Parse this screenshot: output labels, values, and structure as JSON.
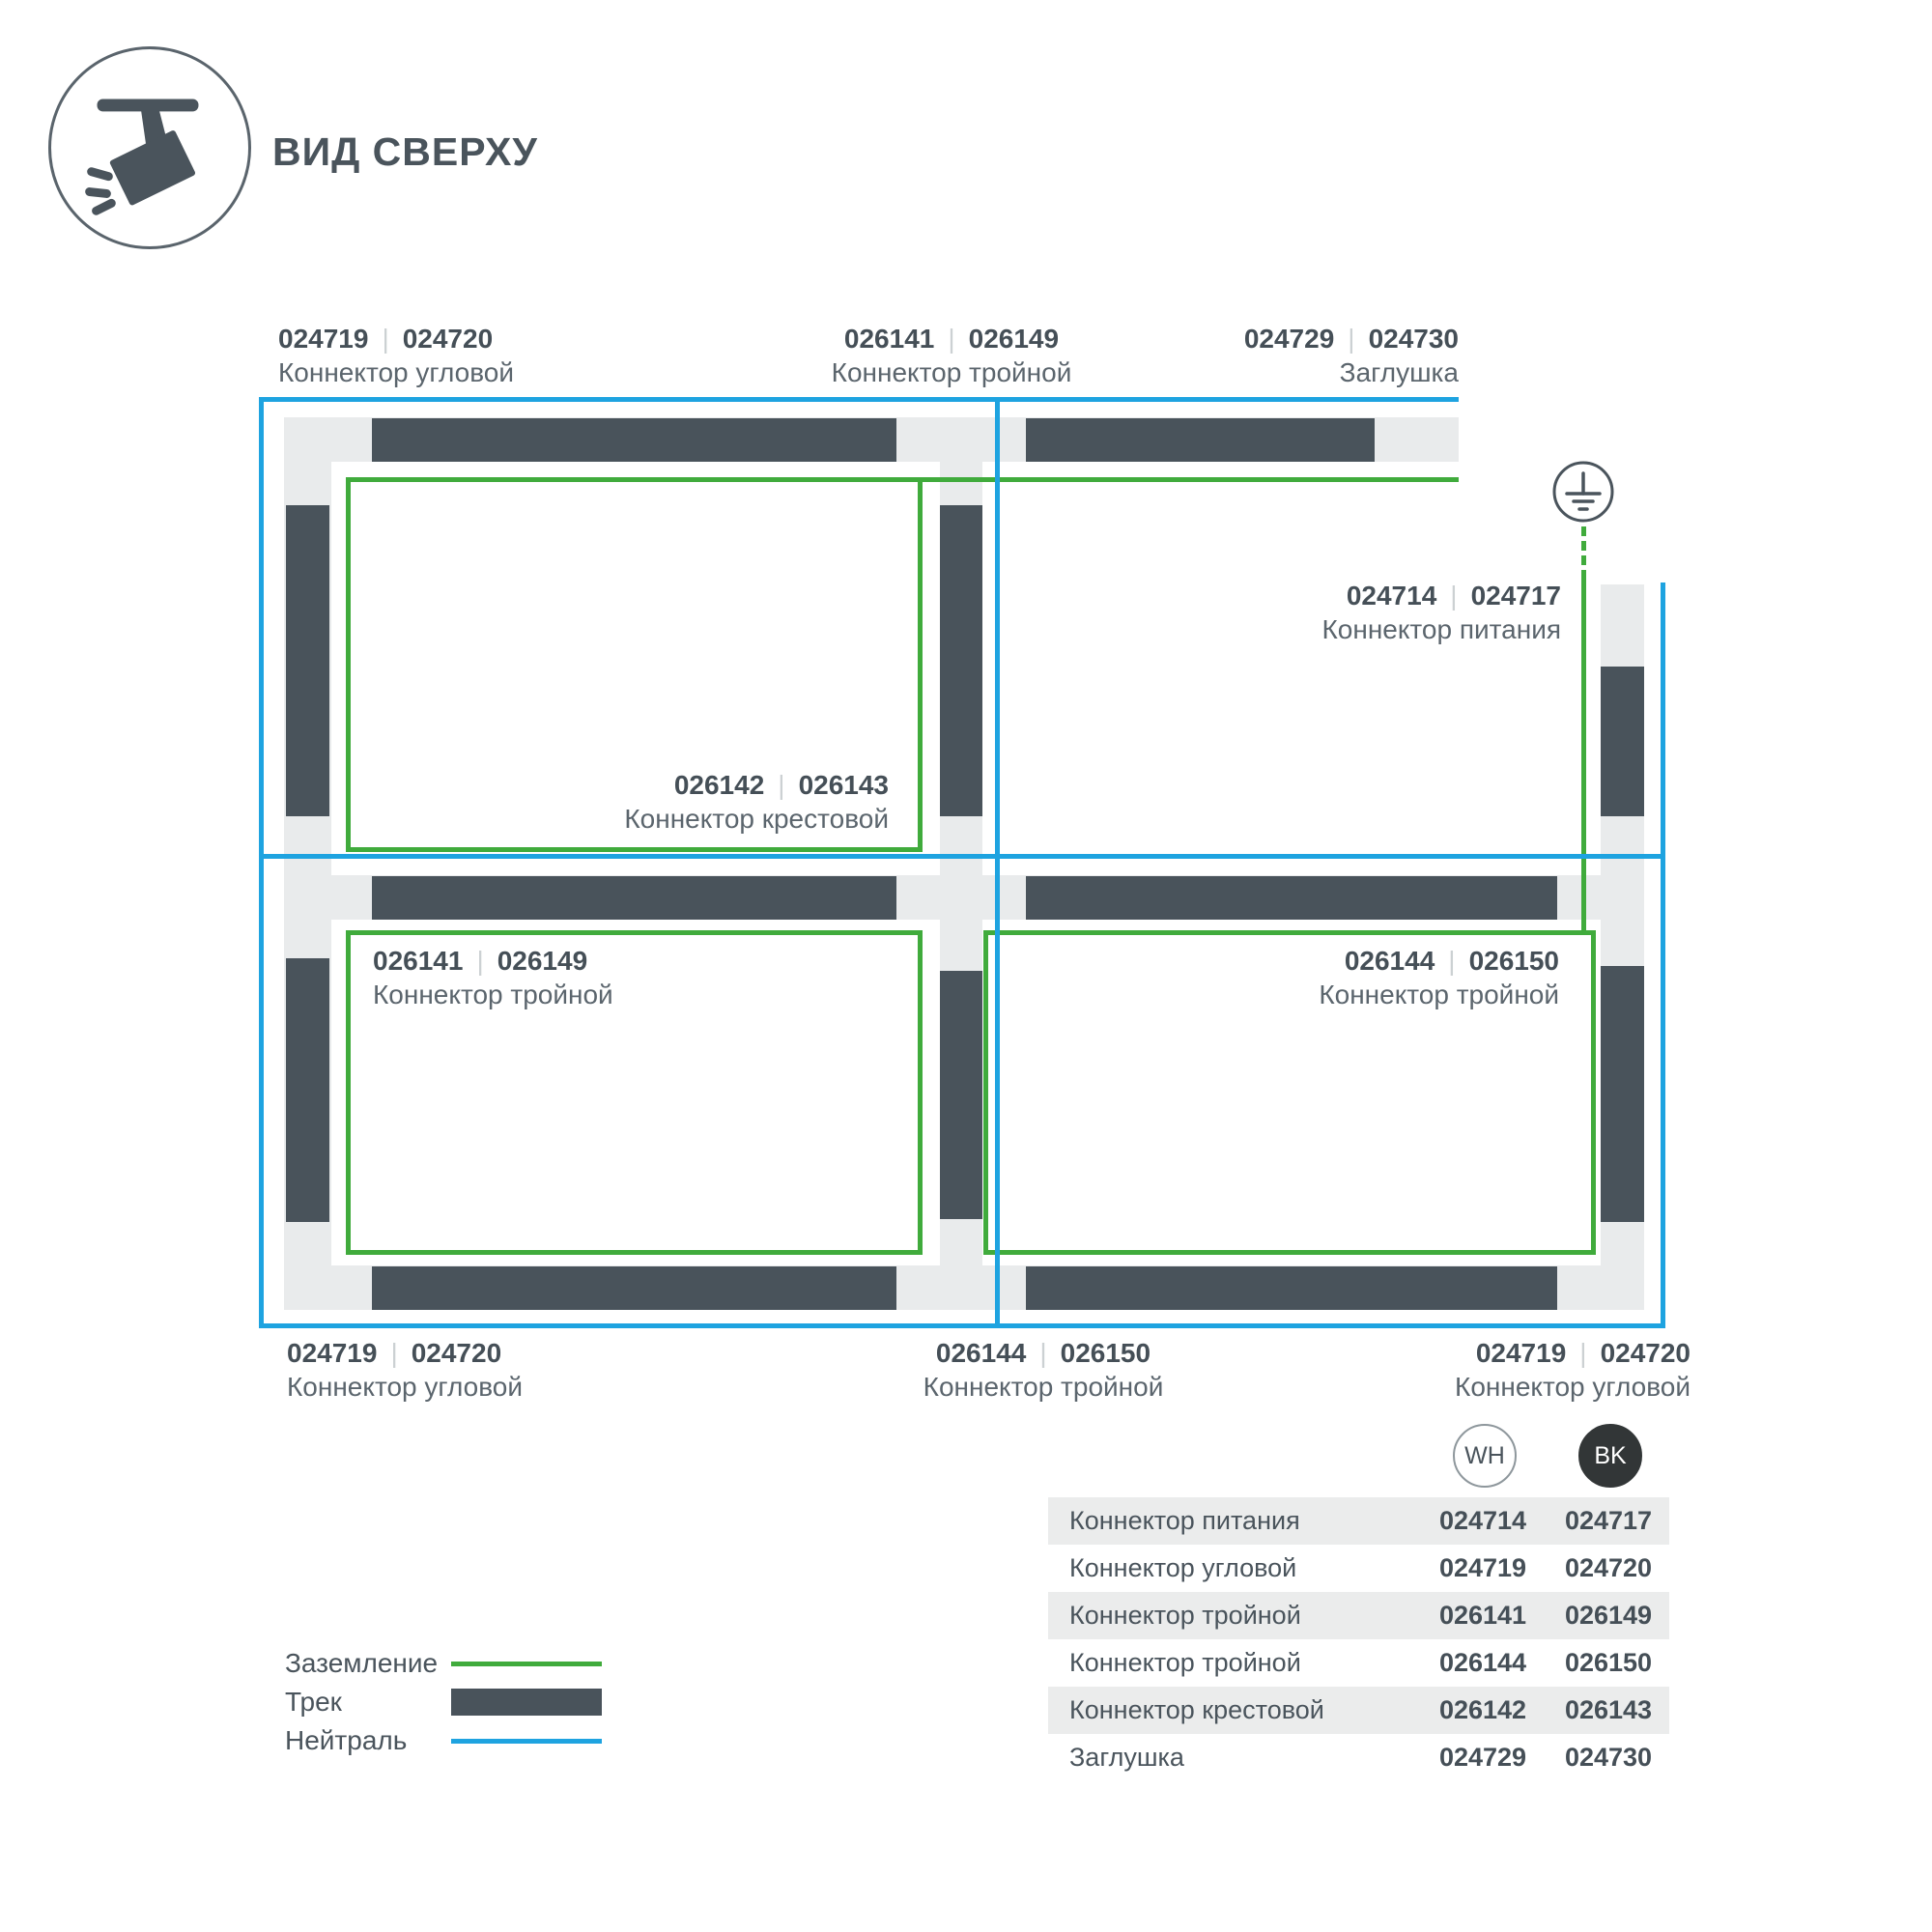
{
  "header": {
    "title": "ВИД СВЕРХУ",
    "icon": "track-spotlight-icon"
  },
  "colors": {
    "track_dark": "#49535b",
    "track_light": "#e9ebec",
    "ground_green": "#40ab3c",
    "neutral_blue": "#1ea3e0",
    "text_dark": "#454f57",
    "text_muted": "#5b656d",
    "table_band": "#ebecec",
    "bk_circle": "#323637"
  },
  "diagram": {
    "ground_symbol": "earth-ground-icon",
    "connector_labels": [
      {
        "wh": "024719",
        "bk": "024720",
        "name": "Коннектор угловой"
      },
      {
        "wh": "026141",
        "bk": "026149",
        "name": "Коннектор тройной"
      },
      {
        "wh": "024729",
        "bk": "024730",
        "name": "Заглушка"
      },
      {
        "wh": "024714",
        "bk": "024717",
        "name": "Коннектор питания"
      },
      {
        "wh": "026142",
        "bk": "026143",
        "name": "Коннектор крестовой"
      },
      {
        "wh": "026141",
        "bk": "026149",
        "name": "Коннектор тройной"
      },
      {
        "wh": "026144",
        "bk": "026150",
        "name": "Коннектор тройной"
      },
      {
        "wh": "024719",
        "bk": "024720",
        "name": "Коннектор угловой"
      },
      {
        "wh": "026144",
        "bk": "026150",
        "name": "Коннектор тройной"
      },
      {
        "wh": "024719",
        "bk": "024720",
        "name": "Коннектор угловой"
      }
    ],
    "separator_glyph": "|"
  },
  "legend": {
    "items": [
      {
        "label": "Заземление",
        "swatch": "ground-line"
      },
      {
        "label": "Трек",
        "swatch": "track-bar"
      },
      {
        "label": "Нейтраль",
        "swatch": "neutral-line"
      }
    ]
  },
  "table": {
    "col_headers": [
      "WH",
      "BK"
    ],
    "rows": [
      {
        "name": "Коннектор питания",
        "wh": "024714",
        "bk": "024717"
      },
      {
        "name": "Коннектор угловой",
        "wh": "024719",
        "bk": "024720"
      },
      {
        "name": "Коннектор тройной",
        "wh": "026141",
        "bk": "026149"
      },
      {
        "name": "Коннектор тройной",
        "wh": "026144",
        "bk": "026150"
      },
      {
        "name": "Коннектор крестовой",
        "wh": "026142",
        "bk": "026143"
      },
      {
        "name": "Заглушка",
        "wh": "024729",
        "bk": "024730"
      }
    ]
  }
}
